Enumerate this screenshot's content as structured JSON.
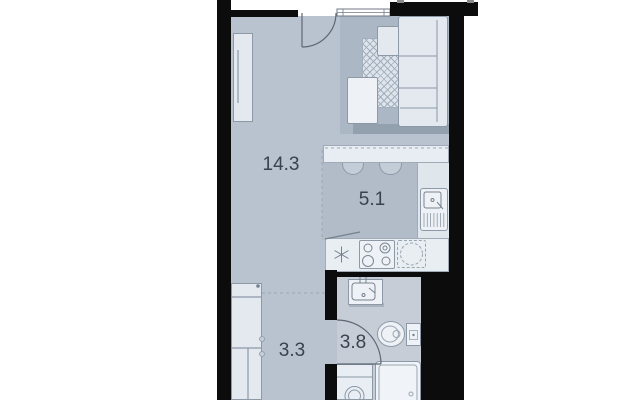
{
  "floorplan": {
    "rooms": {
      "living": {
        "name": "living-room",
        "area": "14.3"
      },
      "kitchen": {
        "name": "kitchen-zone",
        "area": "5.1"
      },
      "hallway": {
        "name": "hallway",
        "area": "3.3"
      },
      "bathroom": {
        "name": "bathroom",
        "area": "3.8"
      }
    },
    "fixtures": [
      "entry-door",
      "window",
      "wardrobe",
      "sofa",
      "ottoman",
      "patterned-rug",
      "coffee-table",
      "bar-table",
      "bar-stools",
      "kitchen-sink",
      "cooktop",
      "built-in-appliance",
      "hallway-wardrobe",
      "bathroom-door",
      "washbasin",
      "toilet",
      "shower-tray",
      "washing-machine"
    ],
    "colors": {
      "wall": "#0c0c0c",
      "floor": "#b8c3cf",
      "kitchen_floor": "#b1bcc8",
      "bathroom_floor": "#c6cdd6",
      "rug_area": "#abb7c4",
      "furniture_fill": "#e3e9ef",
      "fixture_fill": "#eef2f6",
      "outline": "#8d99a7",
      "label_text": "#39424d"
    }
  }
}
